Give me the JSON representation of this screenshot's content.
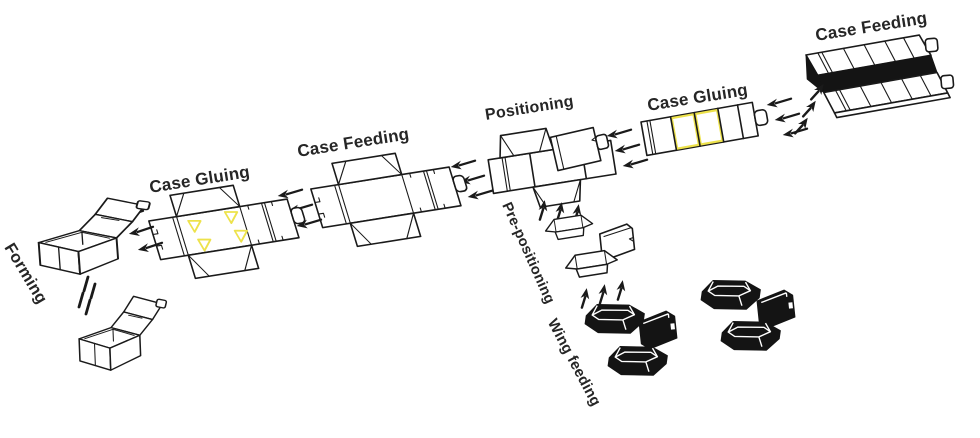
{
  "diagram": {
    "type": "process-flow",
    "stations": [
      {
        "id": "case-feeding-top",
        "label": "Case Feeding"
      },
      {
        "id": "case-gluing-right",
        "label": "Case Gluing"
      },
      {
        "id": "positioning",
        "label": "Positioning"
      },
      {
        "id": "pre-positioning",
        "label": "Pre-positioning"
      },
      {
        "id": "wing-feeding",
        "label": "Wing feeding"
      },
      {
        "id": "case-feeding-mid",
        "label": "Case Feeding"
      },
      {
        "id": "case-gluing-left",
        "label": "Case Gluing"
      },
      {
        "id": "forming",
        "label": "Forming"
      }
    ],
    "main_flow_right_to_left": [
      "Case Feeding",
      "Case Gluing",
      "Positioning",
      "Case Feeding",
      "Case Gluing",
      "Forming"
    ],
    "side_feed_bottom_to_top": [
      "Wing feeding",
      "Pre-positioning",
      "Positioning"
    ],
    "colors": {
      "background": "#ffffff",
      "line": "#1a1a1a",
      "label_text": "#262626",
      "glue_highlight": "#ede24b",
      "fill_dark": "#141414"
    }
  }
}
